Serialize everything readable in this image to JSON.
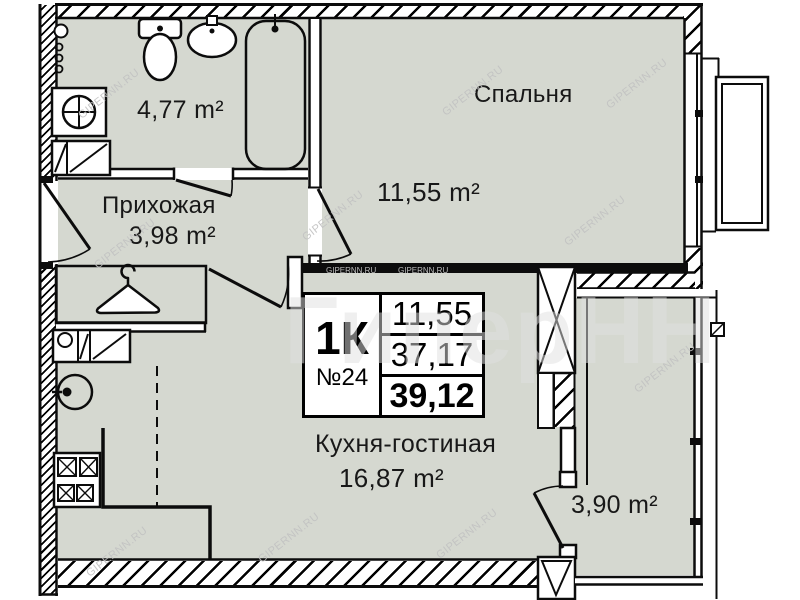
{
  "watermark": {
    "text": "GIPERNN.RU",
    "big_text": "ГиперНН"
  },
  "info_box": {
    "type": "1К",
    "number": "№24",
    "living_area": "11,55",
    "area_without_balcony": "37,17",
    "total_area": "39,12"
  },
  "rooms": {
    "bathroom": {
      "area": "4,77 m²"
    },
    "hallway": {
      "name": "Прихожая",
      "area": "3,98 m²"
    },
    "bedroom": {
      "name": "Спальня",
      "area": "11,55 m²"
    },
    "kitchen_living": {
      "name": "Кухня-гостиная",
      "area": "16,87 m²"
    },
    "balcony": {
      "area": "3,90 m²"
    }
  },
  "colors": {
    "room_fill": "#d5d8d0",
    "line": "#0c0c0c",
    "text": "#181818",
    "watermark": "#c2c2c2",
    "background": "#ffffff"
  }
}
